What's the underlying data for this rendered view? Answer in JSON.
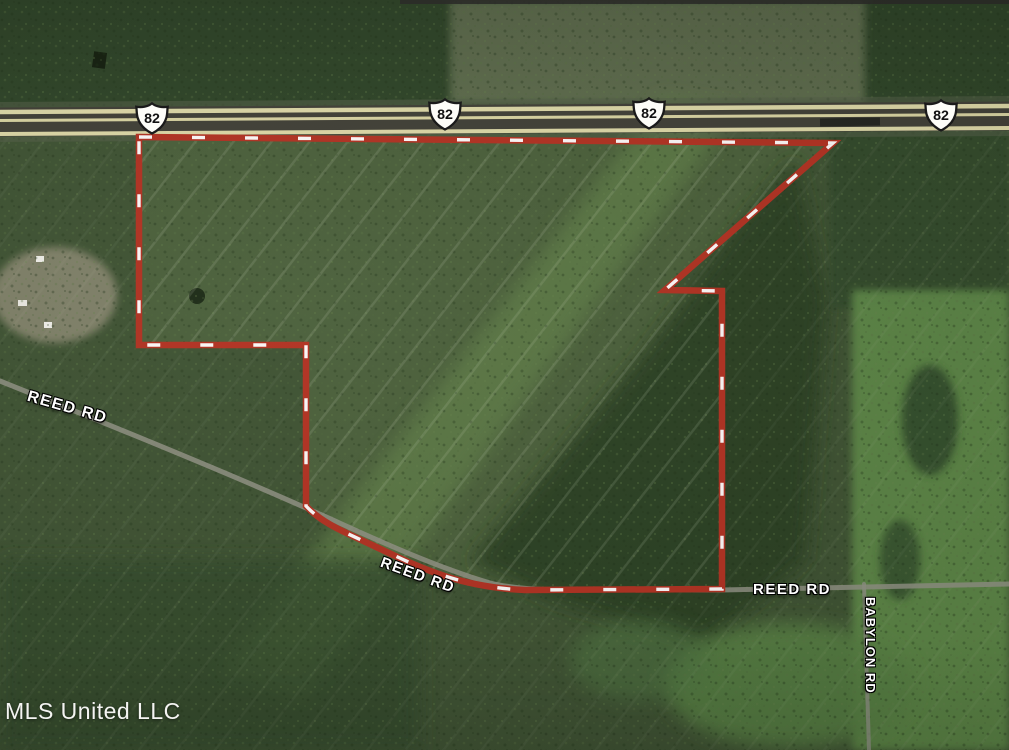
{
  "map": {
    "kind": "satellite-aerial-parcel-view",
    "attribution": "MLS United LLC",
    "highway": {
      "route_number": "82",
      "shield_icon": "us-route-shield",
      "shield_count": 4
    },
    "labels": {
      "reed_rd_west": "REED RD",
      "reed_rd_mid": "REED RD",
      "reed_rd_east": "REED RD",
      "babylon_rd": "BABYLON RD"
    },
    "colors": {
      "boundary_red": "#b13121",
      "boundary_dash": "#ffffff",
      "highway_stripe": "#dcd7a6",
      "highway_asphalt": "#403f36",
      "road_gray": "#8f9183",
      "label_text": "#ffffff"
    }
  }
}
